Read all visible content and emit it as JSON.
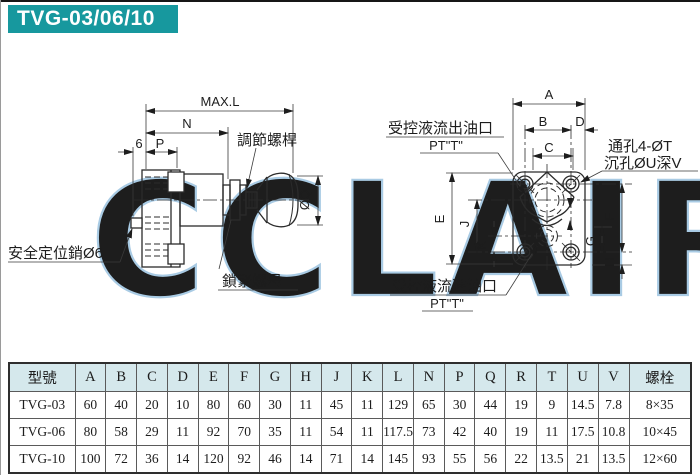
{
  "title": "TVG-03/06/10",
  "watermark": "CCLAIR",
  "diagram_left": {
    "dim_max_l": "MAX.L",
    "dim_n": "N",
    "dim_6": "6",
    "dim_p": "P",
    "dim_phi_q": "ØQ",
    "label_adjusting_rod": "調節螺桿",
    "label_lock_nut": "鎖緊螺母",
    "label_safety_pin": "安全定位銷Ø6"
  },
  "diagram_right": {
    "label_outlet_line1": "受控液流出油口",
    "label_outlet_line2": "PT\"T\"",
    "label_through_holes": "通孔4-ØT",
    "label_counterbore": "沉孔ØU深V",
    "label_inlet_line1": "受控液流進油口",
    "label_inlet_line2": "PT\"T\"",
    "dim_a": "A",
    "dim_b": "B",
    "dim_c": "C",
    "dim_d": "D",
    "dim_e": "E",
    "dim_f": "F",
    "dim_g": "G",
    "dim_h": "H",
    "dim_j": "J",
    "dim_k": "K"
  },
  "table": {
    "headers": [
      "型號",
      "A",
      "B",
      "C",
      "D",
      "E",
      "F",
      "G",
      "H",
      "J",
      "K",
      "L",
      "N",
      "P",
      "Q",
      "R",
      "T",
      "U",
      "V",
      "螺栓"
    ],
    "rows": [
      [
        "TVG-03",
        "60",
        "40",
        "20",
        "10",
        "80",
        "60",
        "30",
        "11",
        "45",
        "11",
        "129",
        "65",
        "30",
        "44",
        "19",
        "9",
        "14.5",
        "7.8",
        "8×35"
      ],
      [
        "TVG-06",
        "80",
        "58",
        "29",
        "11",
        "92",
        "70",
        "35",
        "11",
        "54",
        "11",
        "117.5",
        "73",
        "42",
        "40",
        "19",
        "11",
        "17.5",
        "10.8",
        "10×45"
      ],
      [
        "TVG-10",
        "100",
        "72",
        "36",
        "14",
        "120",
        "92",
        "46",
        "14",
        "71",
        "14",
        "145",
        "93",
        "55",
        "56",
        "22",
        "13.5",
        "21",
        "13.5",
        "12×60"
      ]
    ]
  },
  "colors": {
    "accent": "#17989e",
    "table_header_bg": "#d5e8ec",
    "watermark": "#a9cbe4",
    "line": "#2b2b2b"
  }
}
